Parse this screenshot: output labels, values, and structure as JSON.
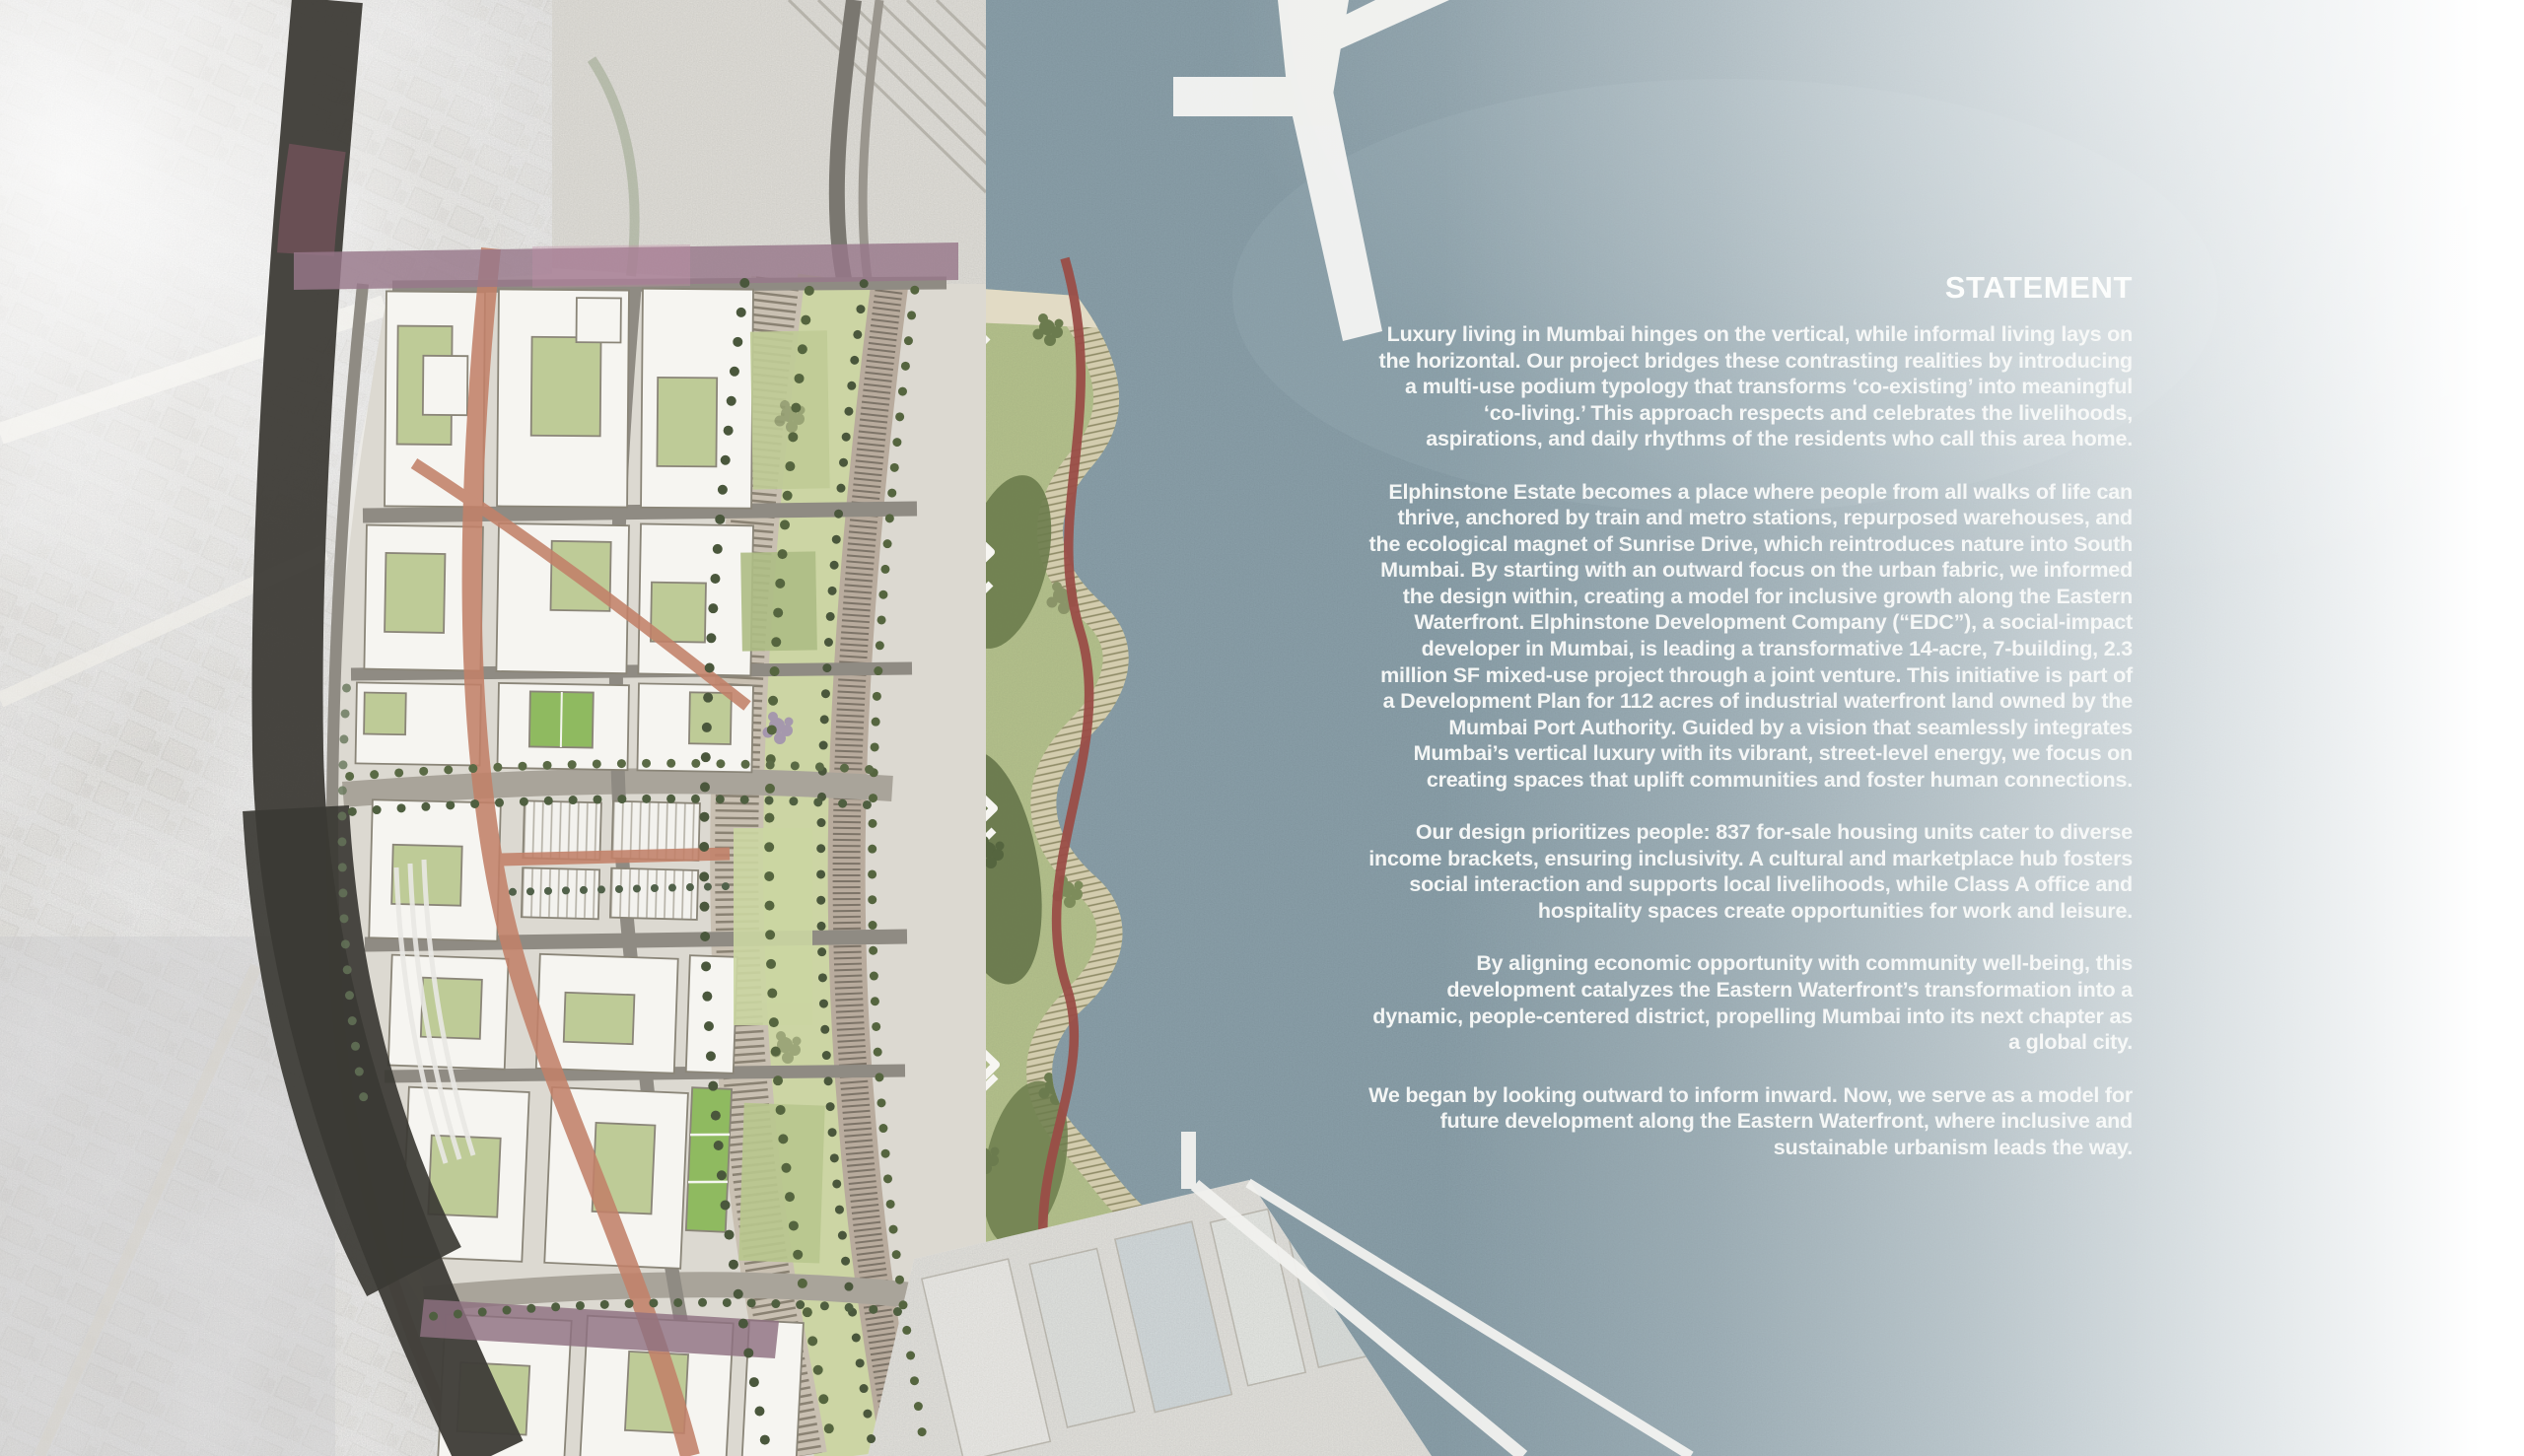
{
  "statement": {
    "title": "STATEMENT",
    "paragraphs": [
      "Luxury living in Mumbai hinges on the vertical, while informal living lays on the horizontal. Our project bridges these contrasting realities by introducing a multi-use podium typology that transforms ‘co-existing’ into meaningful ‘co-living.’ This approach respects and celebrates the livelihoods, aspirations, and daily rhythms of the residents who call this area home.",
      "Elphinstone Estate becomes a place where people from all walks of life can thrive, anchored by train and metro stations, repurposed warehouses, and the ecological magnet of Sunrise Drive, which reintroduces nature into South Mumbai. By starting with an outward focus on the urban fabric, we informed the design within, creating a model for inclusive growth along the Eastern Waterfront. Elphinstone Development Company (“EDC”), a social-impact developer in Mumbai, is leading a transformative 14-acre, 7-building, 2.3 million SF mixed-use project through a joint venture. This initiative is part of a Development Plan for 112 acres of industrial waterfront land owned by the Mumbai Port Authority. Guided by a vision that seamlessly integrates Mumbai’s vertical luxury with its vibrant, street-level energy, we focus on creating spaces that uplift communities and foster human connections.",
      "Our design prioritizes people: 837 for-sale housing units cater to diverse income brackets, ensuring inclusivity. A cultural and marketplace hub fosters social interaction and supports local livelihoods, while Class A office and hospitality spaces create opportunities for work and leisure.",
      "By aligning economic opportunity with community well-being, this development catalyzes the Eastern Waterfront’s transformation into a dynamic, people-centered district, propelling Mumbai into its next chapter as a global city.",
      "We began by looking outward to inform inward. Now, we serve as a model for future development along the Eastern Waterfront, where inclusive and sustainable urbanism leads the way."
    ]
  },
  "map": {
    "title": "Elphinstone Estate master plan over aerial photo of Mumbai Eastern Waterfront",
    "colors": {
      "water": "#8ea4ae",
      "aerial_land": "#e8e6e1",
      "park_green": "#b7c48f",
      "lawn_green": "#ccd5a4",
      "pitch_green": "#8fba60",
      "building_white": "#f6f5f1",
      "street_gray": "#8f8b83",
      "avenue_salmon": "#c28169",
      "ribbon_red": "#9a4d47",
      "rail_dark": "#413f3a",
      "bridge_mauve": "#97788a",
      "text_white": "#fafbfa"
    }
  }
}
